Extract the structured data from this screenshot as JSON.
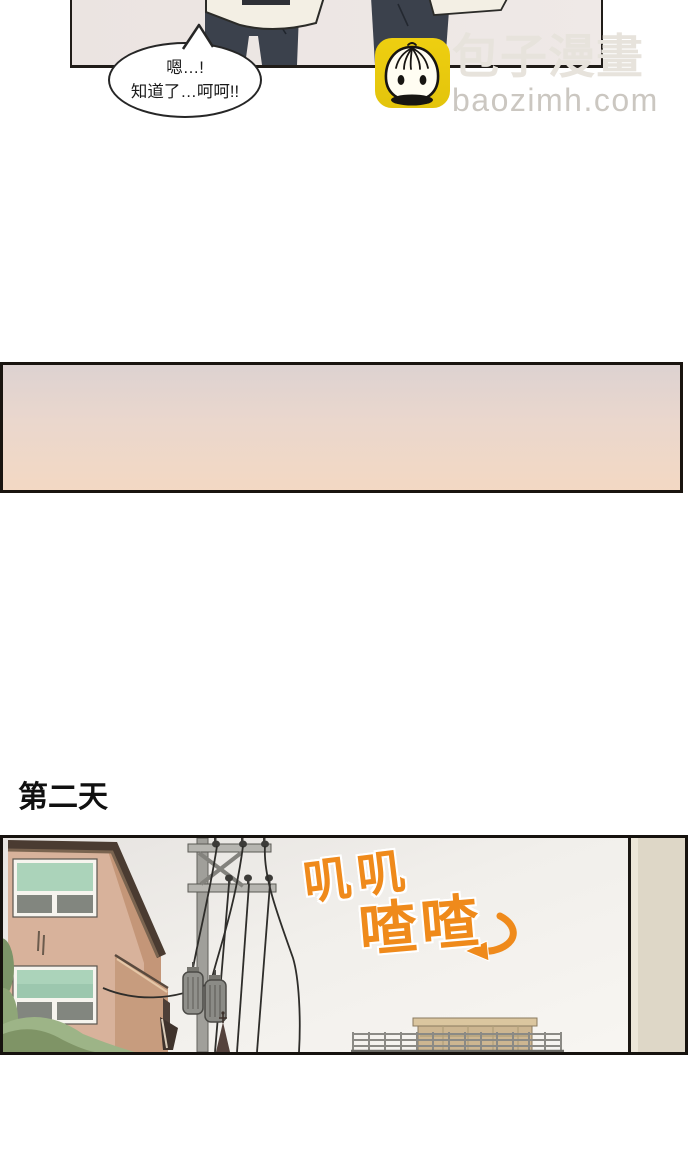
{
  "comic": {
    "panel_top": {
      "speech_bubble": {
        "line1": "嗯…!",
        "line2": "知道了…呵呵!!"
      }
    },
    "watermark": {
      "brand_cjk": "包子漫畫",
      "brand_url": "baozimh.com",
      "icon": "baozi-bun-icon"
    },
    "caption": "第二天",
    "panel_bottom": {
      "sfx_top": "叽叽",
      "sfx_bottom": "喳喳"
    }
  },
  "colors": {
    "accent_orange": "#ef8a1b",
    "icon_yellow": "#eecf10",
    "gradient_top": "#ddd2d1",
    "gradient_bottom": "#f3d8c3",
    "pants_navy": "#3b414c",
    "wall_tan": "#d8b29b",
    "window_mint": "#abd3ba",
    "roof_brown": "#4a3b31"
  }
}
